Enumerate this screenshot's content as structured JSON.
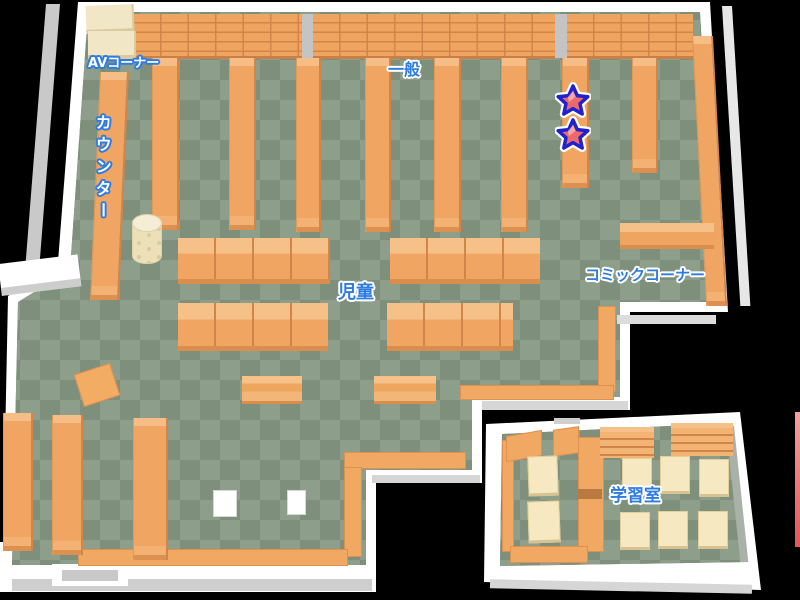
{
  "map": {
    "name": "library-floor-map",
    "areas": {
      "av_corner": "AVコーナー",
      "counter": "カウンター",
      "general": "一般",
      "children": "児童",
      "comic_corner": "コミックコーナー",
      "study_room": "学習室"
    },
    "markers": {
      "stars": [
        {
          "x": 573,
          "y": 100
        },
        {
          "x": 573,
          "y": 134
        }
      ]
    },
    "colors": {
      "floor_light": "#8d9e8b",
      "floor_dark": "#7e8f7c",
      "shelf_orange": "#f0a662",
      "shelf_shadow": "#d2854a",
      "wall": "#ffffff",
      "wall_shadow": "#c9c9c9",
      "table_cream": "#f6e8c0",
      "av_shelf_cream": "#f1e7c6",
      "label_blue": "#2e7ce2",
      "label_white": "#ffffff",
      "star_fill": "#ee6a6a",
      "star_outline": "#2121cd",
      "edge_marker_red": "#e96060",
      "background": "#000000"
    }
  }
}
